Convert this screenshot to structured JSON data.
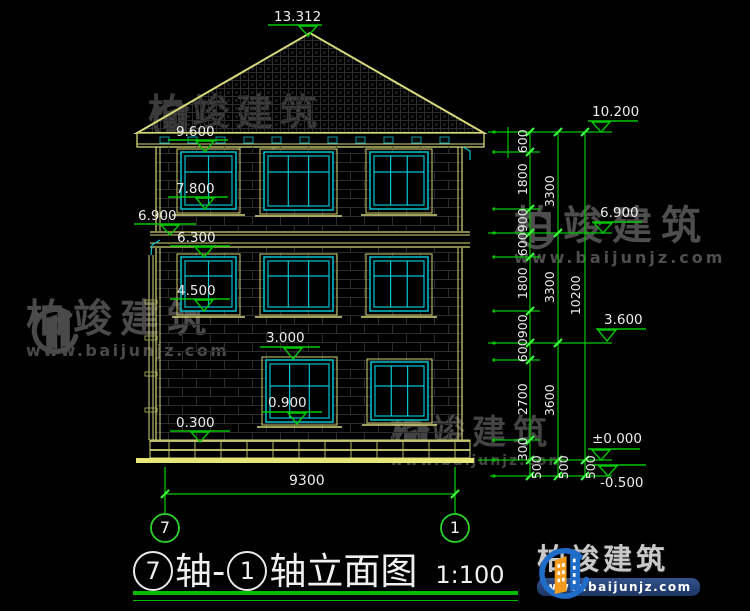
{
  "drawing": {
    "title": {
      "axis_a": "7",
      "mid": "轴-",
      "axis_b": "1",
      "suffix": "轴立面图",
      "scale": "1:100"
    },
    "roof_peak_elevation": "13.312",
    "left_elevations": {
      "l1": "9.600",
      "l2": "7.800",
      "l3": "6.900",
      "l4": "6.300",
      "l5": "4.500",
      "l6": "3.000",
      "l7": "0.900",
      "l8": "0.300"
    },
    "right_elevations": {
      "r1": "10.200",
      "r2": "6.900",
      "r3": "3.600",
      "r4": "±0.000",
      "r5": "-0.500"
    },
    "dims": {
      "inner": [
        "600",
        "1800",
        "900",
        "600",
        "1800",
        "900",
        "600",
        "2700",
        "300",
        "500"
      ],
      "middle": [
        "3300",
        "3300",
        "3600",
        "500"
      ],
      "outer": [
        "10200",
        "500"
      ]
    },
    "bottom": {
      "width": "9300",
      "axis_left": "7",
      "axis_right": "1"
    }
  },
  "watermark": {
    "name": "柏竣建筑",
    "url": "www.baijunjz.com"
  },
  "logo": {
    "name": "柏竣建筑",
    "url": "www.baijunjz.com"
  },
  "colors": {
    "line_yellow": "#d8d87a",
    "line_cyan": "#00c2d1",
    "line_green": "#00c800",
    "text_white": "#ededed",
    "watermark_gray": "#474747",
    "logo_blue": "#1f6cc9",
    "logo_orange": "#f59b1e"
  }
}
